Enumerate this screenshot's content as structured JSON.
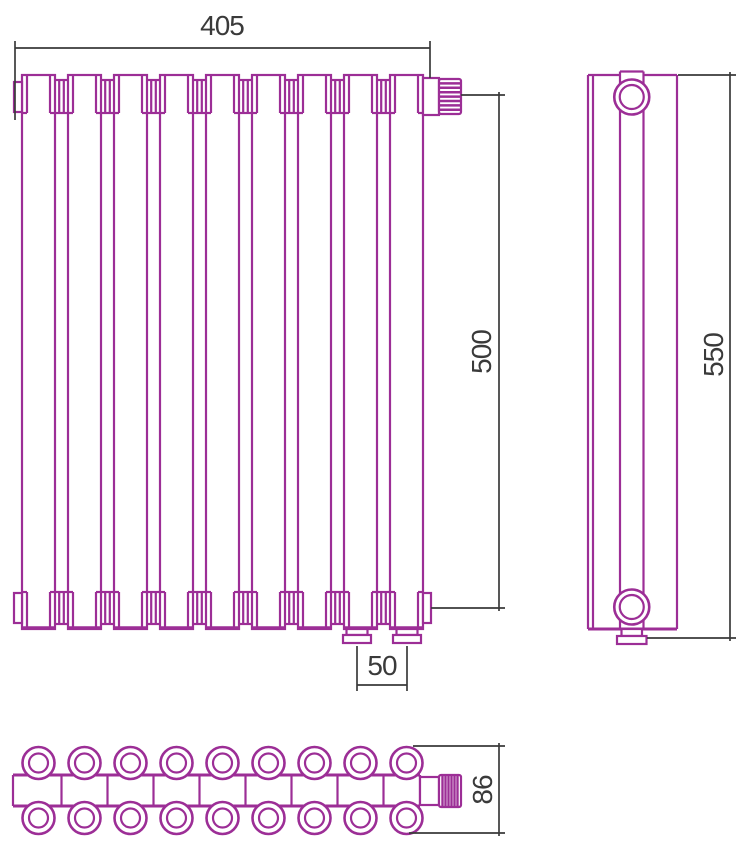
{
  "drawing": {
    "title": "radiator technical drawing",
    "outline_color": "#9c2e96",
    "dimension_color": "#3a3a3a",
    "front_view": {
      "sections": 9,
      "width_label": "405",
      "height_label": "500",
      "connection_spacing_label": "50"
    },
    "side_view": {
      "height_label": "550"
    },
    "top_view": {
      "tubes_per_row": 9,
      "rows": 2,
      "depth_label": "86"
    }
  }
}
